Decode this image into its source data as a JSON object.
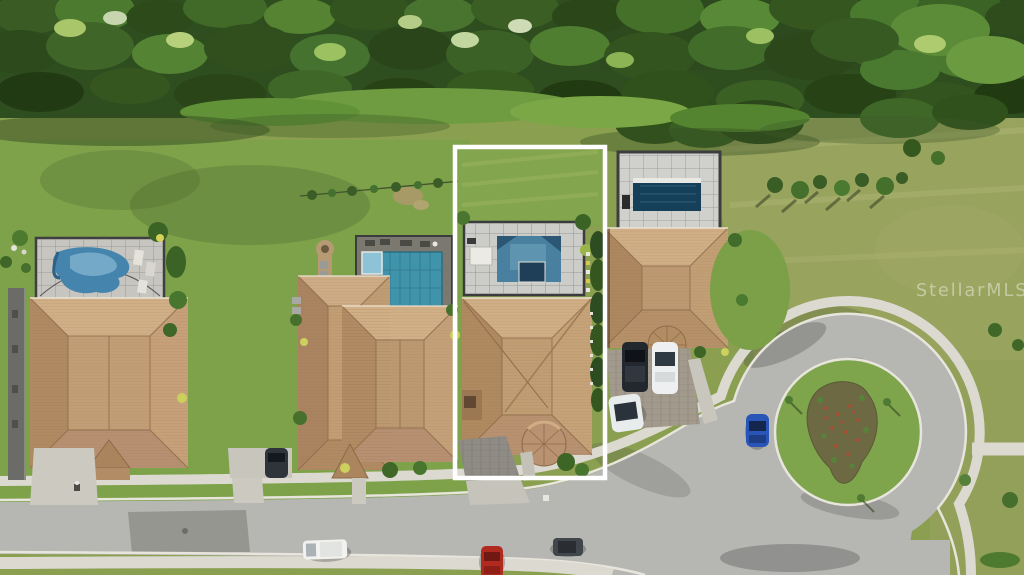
{
  "image": {
    "kind": "aerial real-estate photograph",
    "watermark": "StellarMLS"
  },
  "palette": {
    "forest_green": "#33531f",
    "lawn_green": "#7da24a",
    "field_olive": "#97a25c",
    "asphalt_gray": "#b6b6b3",
    "concrete": "#dcd9d0",
    "roof_tan": "#c09b70",
    "pool_blue": "#4484ad",
    "screen_enclosure_gray": "#cbcbc7",
    "featured_outline": "#ffffff"
  },
  "scene": {
    "featured_lot": "white rectangle outline around center-left home with screened lanai pool",
    "homes_visible": 4,
    "pools_visible": 4,
    "street": "curving residential street ending in landscaped cul-de-sac island",
    "cars": [
      "white van on street",
      "red car at curb",
      "dark gray car on street",
      "blue car in cul-de-sac",
      "dark SUV in right driveway",
      "white sedan in right driveway",
      "white sedan near curb",
      "dark SUV in left driveway"
    ]
  }
}
